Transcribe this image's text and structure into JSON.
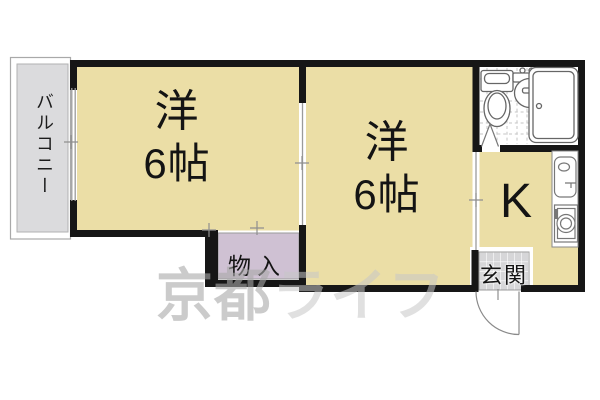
{
  "plan_type": "apartment-floorplan",
  "rooms": {
    "room1": {
      "name": "洋",
      "size": "6帖"
    },
    "room2": {
      "name": "洋",
      "size": "6帖"
    },
    "kitchen": {
      "label": "K"
    },
    "entrance": {
      "label": "玄関"
    },
    "storage": {
      "label": "物入"
    },
    "balcony": {
      "label": "バルコニー"
    }
  },
  "watermark": {
    "part1": "京都",
    "part2": "ライフ"
  },
  "fixtures": {
    "bathroom": [
      "toilet-icon",
      "washbasin-icon",
      "bathtub-icon",
      "folding-door-icon"
    ],
    "kitchen": [
      "kitchen-sink-icon",
      "stove-icon"
    ],
    "entrance": [
      "door-swing-arc"
    ]
  },
  "colors": {
    "room_fill": "#ebdea6",
    "storage_fill": "#cfc1d3",
    "balcony_fill": "#dbdbdd",
    "entrance_tile": "#d6d6d8",
    "wall": "#161616",
    "watermark_gray": "#bcbcbc"
  }
}
